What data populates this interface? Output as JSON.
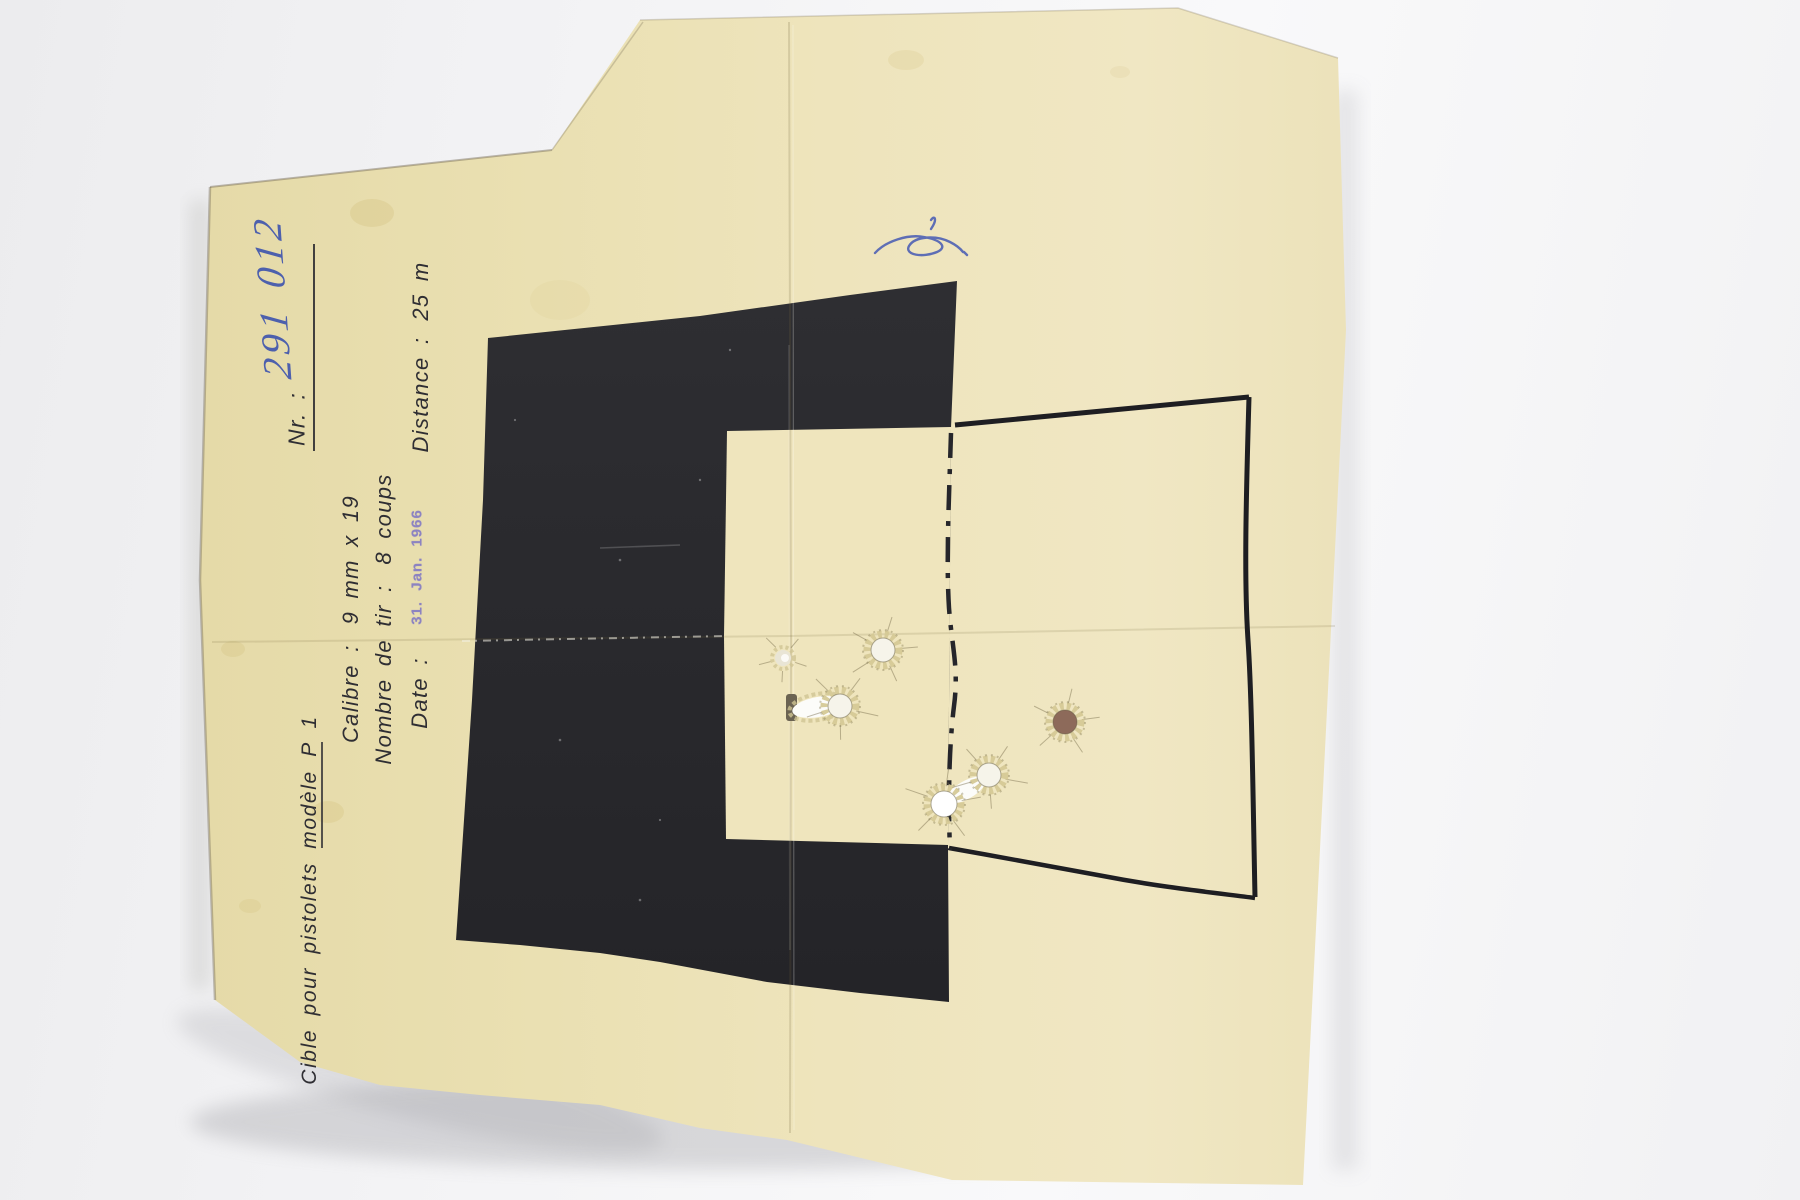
{
  "scene": {
    "background_color": "#f2f2f3",
    "paper_color": "#ebe1b4",
    "black_zone_color": "#29292d",
    "print_color": "#2f2e33",
    "ink_color": "#4156ae",
    "stamp_color": "#837ac4"
  },
  "target": {
    "title": "Cible pour pistolets modèle P 1",
    "fields": {
      "nr": {
        "label": "Nr. :",
        "value": "291 012"
      },
      "calibre": {
        "label": "Calibre :",
        "value": "9 mm x 19"
      },
      "shots": {
        "label": "Nombre de tir :",
        "value": "8 coups"
      },
      "date": {
        "label": "Date :",
        "stamp": "31. Jan. 1966"
      },
      "distance": {
        "label": "Distance :",
        "value": "25 m"
      }
    },
    "marks": {
      "signature": "blue-ink-scribble"
    },
    "bullet_holes": [
      {
        "type": "small-tear",
        "x": 783,
        "y": 658,
        "r": 8
      },
      {
        "type": "crown",
        "x": 883,
        "y": 650,
        "r": 12
      },
      {
        "type": "long-tear",
        "x": 818,
        "y": 707,
        "rx": 26,
        "ry": 10,
        "rot": -10
      },
      {
        "type": "crown",
        "x": 840,
        "y": 706,
        "r": 12
      },
      {
        "type": "crown-dark",
        "x": 1065,
        "y": 722,
        "r": 12
      },
      {
        "type": "tear-bridge",
        "x": 966,
        "y": 790,
        "rx": 22,
        "ry": 9,
        "rot": -30
      },
      {
        "type": "crown",
        "x": 989,
        "y": 775,
        "r": 12
      },
      {
        "type": "crown-bright",
        "x": 944,
        "y": 804,
        "r": 13
      }
    ]
  }
}
